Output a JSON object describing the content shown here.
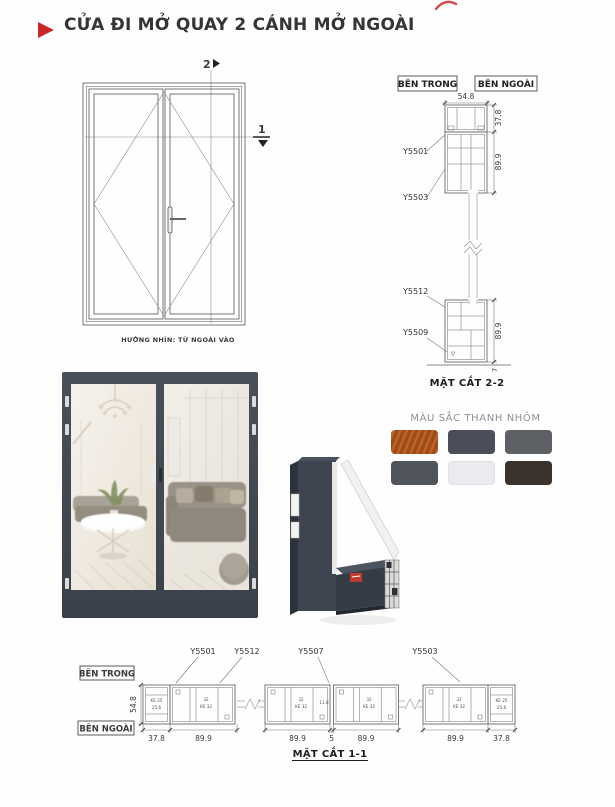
{
  "page": {
    "title": "CỬA ĐI MỞ QUAY 2 CÁNH MỞ NGOÀI",
    "accent_color": "#c9252b"
  },
  "elevation": {
    "caption": "HƯỚNG NHÌN: TỪ NGOÀI VÀO",
    "section_marker_top": "2",
    "section_marker_side": "1"
  },
  "section_2_2": {
    "caption": "MẶT CẮT 2-2",
    "label_inside": "BÊN TRONG",
    "label_outside": "BÊN NGOÀI",
    "profiles": {
      "top_frame": "Y5501",
      "top_sash": "Y5503",
      "bottom_sash": "Y5512",
      "bottom_frame": "Y5509"
    },
    "dims": {
      "width": "54.8",
      "frame_height": "37.8",
      "sash_height": "89.9",
      "bottom_height": "89.9",
      "ground_gap": "7"
    }
  },
  "colors_panel": {
    "title": "MÀU SẮC THANH NHÔM",
    "swatches": [
      {
        "name": "wood-grain",
        "color": "#b3591e"
      },
      {
        "name": "graphite-gray",
        "color": "#4a4e59"
      },
      {
        "name": "medium-gray",
        "color": "#5d6065"
      },
      {
        "name": "slate-gray",
        "color": "#50555c"
      },
      {
        "name": "silver-white",
        "color": "#e9ebee"
      },
      {
        "name": "dark-brown",
        "color": "#3b322b"
      }
    ]
  },
  "section_1_1": {
    "caption": "MẶT CẮT 1-1",
    "label_inside": "BÊN TRONG",
    "label_outside": "BÊN NGOÀI",
    "profile_labels": [
      "Y5501",
      "Y5512",
      "Y5507",
      "Y5503"
    ],
    "dim_height": "54.8",
    "dims_bottom": [
      "37.8",
      "89.9",
      "89.9",
      "5",
      "89.9",
      "89.9",
      "37.8"
    ],
    "chamber_texts": {
      "ke25": "KE 25",
      "v256": "25.6",
      "v32": "32",
      "ke32": "KE 32",
      "v118": "11.8"
    }
  }
}
